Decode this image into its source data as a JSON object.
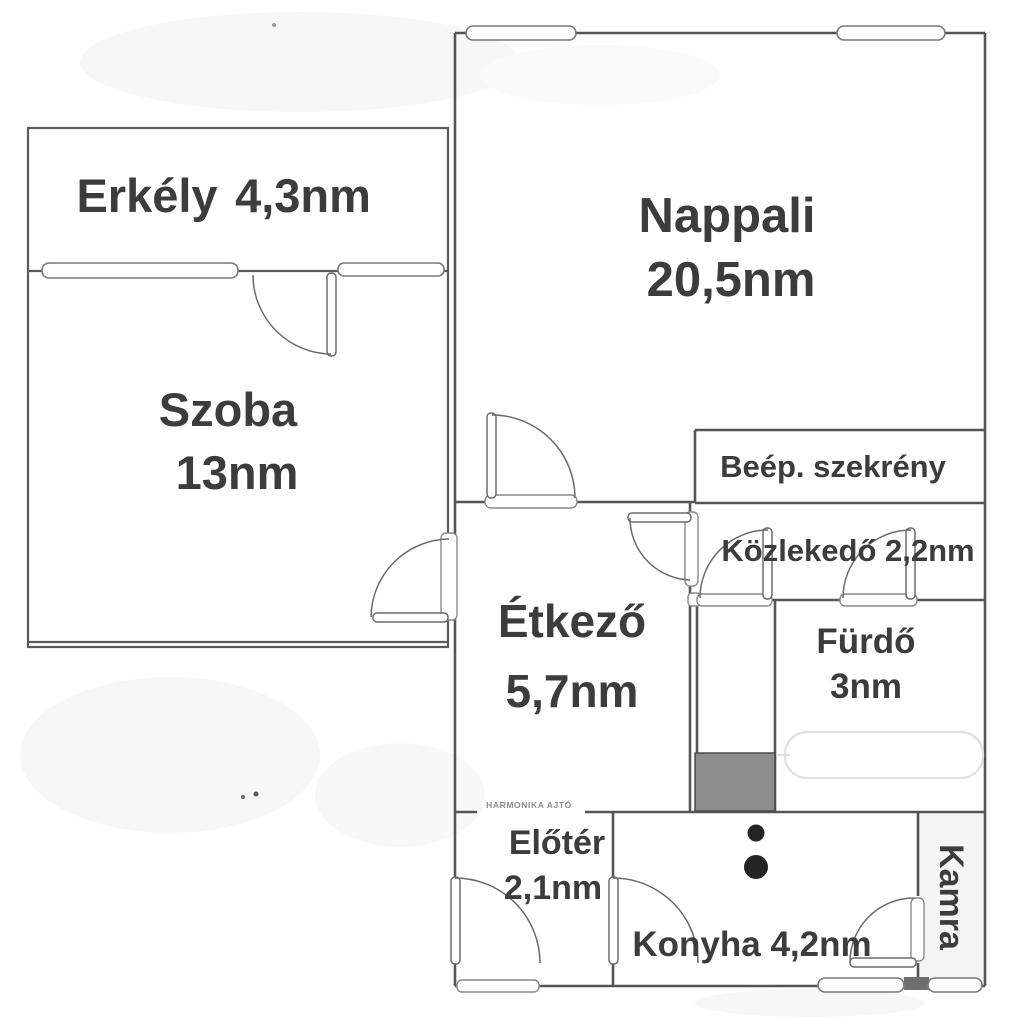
{
  "document_type": "apartment floor plan",
  "colors": {
    "wall": "#555555",
    "label_text": "#3c3c3c",
    "duct_fill": "#8d8d8d",
    "pantry_fill": "#f4f4f4",
    "stove_dots": "#242424",
    "background": "#ffffff"
  },
  "rooms": {
    "erkely": {
      "name": "Erkély",
      "area": "4,3nm"
    },
    "szoba": {
      "name": "Szoba",
      "area": "13nm"
    },
    "nappali": {
      "name": "Nappali",
      "area": "20,5nm"
    },
    "beep_szekreny": {
      "name": "Beép. szekrény"
    },
    "kozlekedo": {
      "label": "Közlekedő 2,2nm"
    },
    "etkezo": {
      "name": "Étkező",
      "area": "5,7nm"
    },
    "furdo": {
      "name": "Fürdő",
      "area": "3nm"
    },
    "eloter": {
      "name": "Előtér",
      "area": "2,1nm"
    },
    "konyha": {
      "label": "Konyha 4,2nm"
    },
    "kamra": {
      "name": "Kamra"
    }
  },
  "annotations": {
    "folding_door": "HARMONIKA AJTÓ"
  }
}
